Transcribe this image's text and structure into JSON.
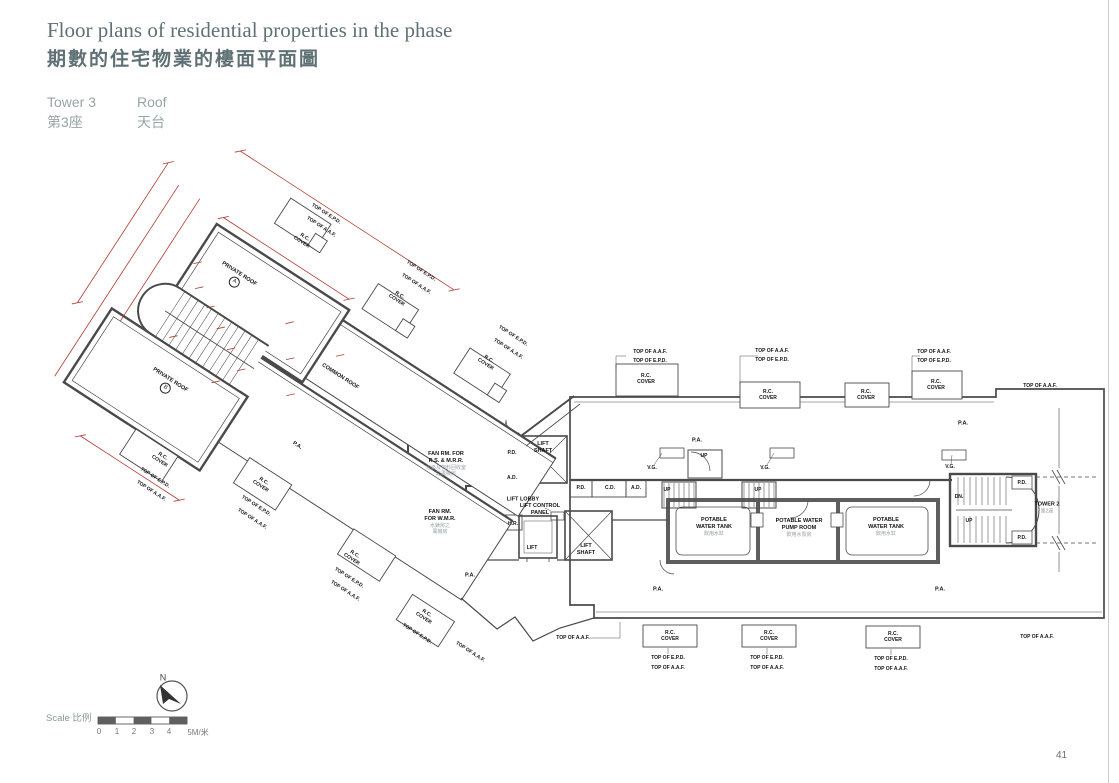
{
  "header": {
    "title_en": "Floor plans of residential properties in the phase",
    "title_zh": "期數的住宅物業的樓面平面圖",
    "tower_en": "Tower 3",
    "tower_zh": "第3座",
    "floor_en": "Roof",
    "floor_zh": "天台"
  },
  "labels": {
    "pa": "P.A.",
    "rc1": "R.C.",
    "rc2": "COVER",
    "top_epd": "TOP OF E.P.D.",
    "top_aaf": "TOP OF A.A.F.",
    "private_roof": "PRIVATE ROOF",
    "flat_a": "A",
    "flat_b": "B",
    "common_roof": "COMMON ROOF",
    "vg": "V.G.",
    "pd": "P.D.",
    "cd": "C.D.",
    "ad": "A.D.",
    "hr": "H.R.",
    "up": "UP",
    "dn": "DN.",
    "lift1": "LIFT",
    "lift2": "SHAFT",
    "lift_lobby": "LIFT LOBBY",
    "lift_control1": "LIFT CONTROL",
    "lift_control2": "PANEL",
    "lift_car": "LIFT"
  },
  "rooms": {
    "fan_rs": {
      "l1": "FAN RM. FOR",
      "l2": "R.S. & M.R.R.",
      "zh1": "垃圾及物料回收室",
      "zh2": "之風機房"
    },
    "fan_wmr": {
      "l1": "FAN RM.",
      "l2": "FOR W.M.R.",
      "zh1": "水錶房之",
      "zh2": "風機房"
    },
    "tank": {
      "l1": "POTABLE",
      "l2": "WATER TANK",
      "zh": "飲用水缸"
    },
    "pump": {
      "l1": "POTABLE WATER",
      "l2": "PUMP ROOM",
      "zh": "飲用水泵房"
    }
  },
  "tower2": {
    "en": "TOWER 2",
    "zh": "第2座"
  },
  "compass": {
    "n": "N"
  },
  "scale": {
    "label": "Scale 比例",
    "ticks": [
      "0",
      "1",
      "2",
      "3",
      "4",
      "5M/米"
    ]
  },
  "page": {
    "number": "41"
  },
  "colors": {
    "title": "#5f7175",
    "subtitle": "#98a4a6",
    "dim_red": "#b23a31",
    "wall": "#4a4a4a"
  }
}
